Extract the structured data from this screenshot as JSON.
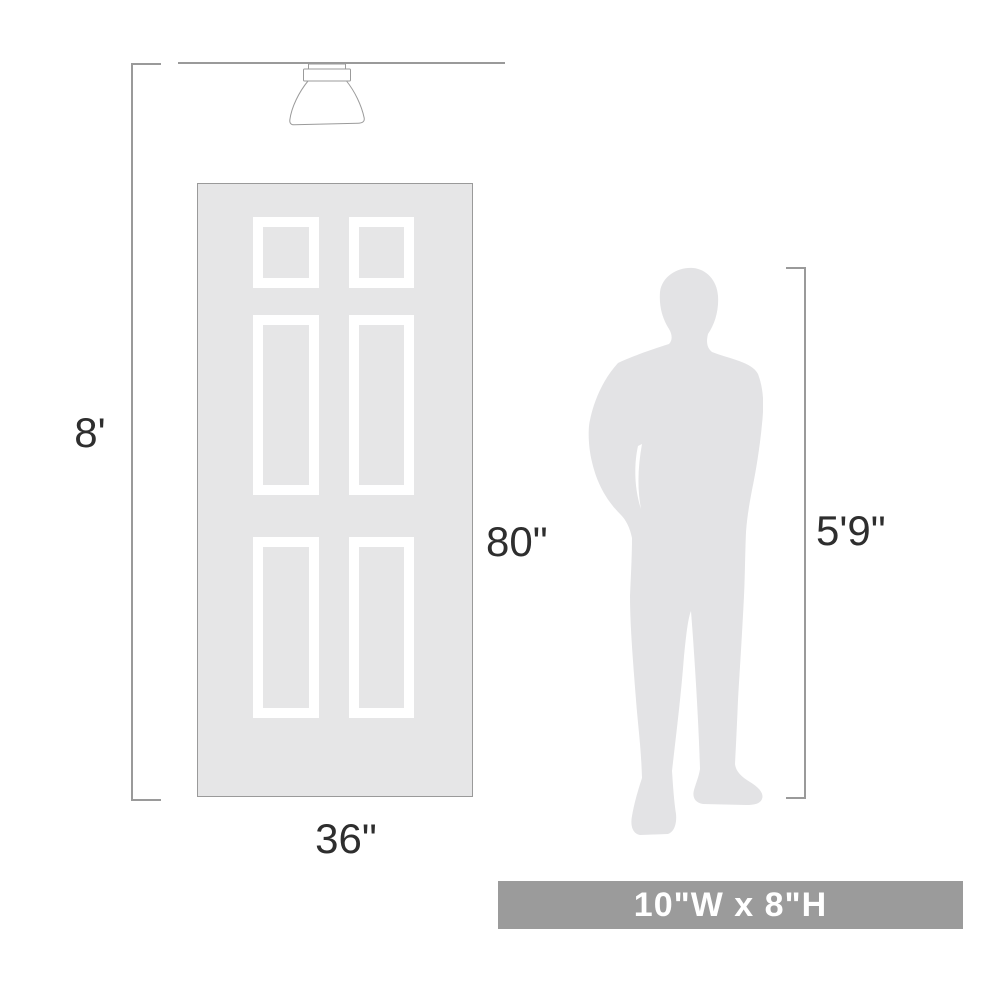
{
  "diagram": {
    "title": "product-scale-diagram",
    "labels": {
      "ceiling_height": "8'",
      "door_height": "80\"",
      "door_width": "36\"",
      "person_height": "5'9\""
    },
    "banner": {
      "text": "10\"W x 8\"H",
      "bg_color": "#9b9b9b",
      "text_color": "#ffffff"
    },
    "icons": {
      "fixture": "ceiling-light-icon",
      "door": "six-panel-door-icon",
      "person": "person-silhouette-icon"
    },
    "colors": {
      "line": "#9a9a9a",
      "door_fill": "#e6e6e7",
      "panel_frame": "#ffffff",
      "silhouette": "#e3e3e5",
      "label_text": "#2e2e2e"
    }
  }
}
